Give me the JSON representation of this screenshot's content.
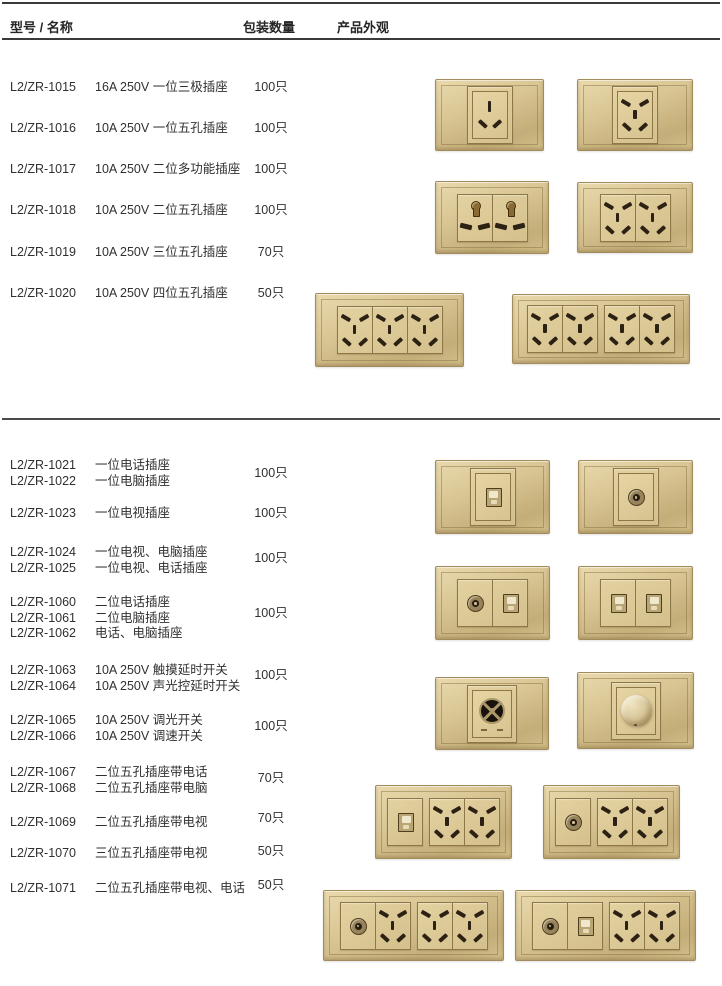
{
  "header": {
    "col_model_name": "型号 / 名称",
    "col_qty": "包装数量",
    "col_appearance": "产品外观"
  },
  "sections": [
    {
      "rows": [
        {
          "models": [
            "L2/ZR-1015"
          ],
          "names": [
            "16A 250V 一位三极插座"
          ],
          "qty": "100只"
        },
        {
          "models": [
            "L2/ZR-1016"
          ],
          "names": [
            "10A 250V 一位五孔插座"
          ],
          "qty": "100只"
        },
        {
          "models": [
            "L2/ZR-1017"
          ],
          "names": [
            "10A 250V 二位多功能插座"
          ],
          "qty": "100只"
        },
        {
          "models": [
            "L2/ZR-1018"
          ],
          "names": [
            "10A 250V 二位五孔插座"
          ],
          "qty": "100只"
        },
        {
          "models": [
            "L2/ZR-1019"
          ],
          "names": [
            "10A 250V 三位五孔插座"
          ],
          "qty": "70只"
        },
        {
          "models": [
            "L2/ZR-1020"
          ],
          "names": [
            "10A 250V 四位五孔插座"
          ],
          "qty": "50只"
        }
      ]
    },
    {
      "rows": [
        {
          "models": [
            "L2/ZR-1021",
            "L2/ZR-1022"
          ],
          "names": [
            "一位电话插座",
            "一位电脑插座"
          ],
          "qty": "100只"
        },
        {
          "models": [
            "L2/ZR-1023"
          ],
          "names": [
            "一位电视插座"
          ],
          "qty": "100只"
        },
        {
          "models": [
            "L2/ZR-1024",
            "L2/ZR-1025"
          ],
          "names": [
            "一位电视、电脑插座",
            "一位电视、电话插座"
          ],
          "qty": "100只"
        },
        {
          "models": [
            "L2/ZR-1060",
            "L2/ZR-1061",
            "L2/ZR-1062"
          ],
          "names": [
            "二位电话插座",
            "二位电脑插座",
            "电话、电脑插座"
          ],
          "qty": "100只"
        },
        {
          "models": [
            "L2/ZR-1063",
            "L2/ZR-1064"
          ],
          "names": [
            "10A 250V 触摸延时开关",
            "10A 250V 声光控延时开关"
          ],
          "qty": "100只"
        },
        {
          "models": [
            "L2/ZR-1065",
            "L2/ZR-1066"
          ],
          "names": [
            "10A 250V 调光开关",
            "10A 250V 调速开关"
          ],
          "qty": "100只"
        },
        {
          "models": [
            "L2/ZR-1067",
            "L2/ZR-1068"
          ],
          "names": [
            "二位五孔插座带电话",
            "二位五孔插座带电脑"
          ],
          "qty": "70只"
        },
        {
          "models": [
            "L2/ZR-1069"
          ],
          "names": [
            "二位五孔插座带电视"
          ],
          "qty": "70只"
        },
        {
          "models": [
            "L2/ZR-1070"
          ],
          "names": [
            "三位五孔插座带电视"
          ],
          "qty": "50只"
        },
        {
          "models": [
            "L2/ZR-1071"
          ],
          "names": [
            "二位五孔插座带电视、电话"
          ],
          "qty": "50只"
        }
      ]
    }
  ],
  "products": [
    {
      "id": "p1",
      "name": "one-gang-three-pin-socket",
      "groups": [
        [
          "three-pin"
        ]
      ]
    },
    {
      "id": "p2",
      "name": "one-gang-five-hole-socket",
      "groups": [
        [
          "five-hole"
        ]
      ]
    },
    {
      "id": "p3",
      "name": "two-gang-multifunction-socket",
      "groups": [
        [
          "multi",
          "multi"
        ]
      ]
    },
    {
      "id": "p4",
      "name": "two-gang-five-hole-socket",
      "groups": [
        [
          "five-hole",
          "five-hole"
        ]
      ]
    },
    {
      "id": "p5",
      "name": "three-gang-five-hole-socket",
      "groups": [
        [
          "five-hole",
          "five-hole",
          "five-hole"
        ]
      ]
    },
    {
      "id": "p6",
      "name": "four-gang-five-hole-socket",
      "groups": [
        [
          "five-hole",
          "five-hole"
        ],
        [
          "five-hole",
          "five-hole"
        ]
      ]
    },
    {
      "id": "p7",
      "name": "telephone-computer-socket",
      "groups": [
        [
          "rj"
        ]
      ]
    },
    {
      "id": "p8",
      "name": "tv-socket",
      "groups": [
        [
          "tv"
        ]
      ]
    },
    {
      "id": "p9",
      "name": "tv-computer-socket",
      "groups": [
        [
          "tv",
          "rj"
        ]
      ]
    },
    {
      "id": "p10",
      "name": "two-gang-jack-socket",
      "groups": [
        [
          "rj",
          "rj"
        ]
      ]
    },
    {
      "id": "p11",
      "name": "sound-light-control-delay-switch",
      "groups": [
        [
          "speaker"
        ]
      ]
    },
    {
      "id": "p12",
      "name": "dimmer-switch",
      "groups": [
        [
          "knob"
        ]
      ]
    },
    {
      "id": "p13",
      "name": "five-hole-with-jack-socket",
      "groups": [
        [
          "rj"
        ],
        [
          "five-hole",
          "five-hole"
        ]
      ]
    },
    {
      "id": "p14",
      "name": "five-hole-with-tv-socket",
      "groups": [
        [
          "tv"
        ],
        [
          "five-hole",
          "five-hole"
        ]
      ]
    },
    {
      "id": "p15",
      "name": "three-gang-five-hole-with-tv-socket",
      "groups": [
        [
          "tv",
          "five-hole"
        ],
        [
          "five-hole",
          "five-hole"
        ]
      ]
    },
    {
      "id": "p16",
      "name": "five-hole-with-tv-phone-socket",
      "groups": [
        [
          "tv",
          "rj"
        ],
        [
          "five-hole",
          "five-hole"
        ]
      ]
    }
  ],
  "colors": {
    "plate_gold": "#d8c593",
    "plate_border": "#a28c5c",
    "hole_dark": "#2c2113",
    "rule_dark": "#3a3a3a",
    "text": "#303030"
  }
}
